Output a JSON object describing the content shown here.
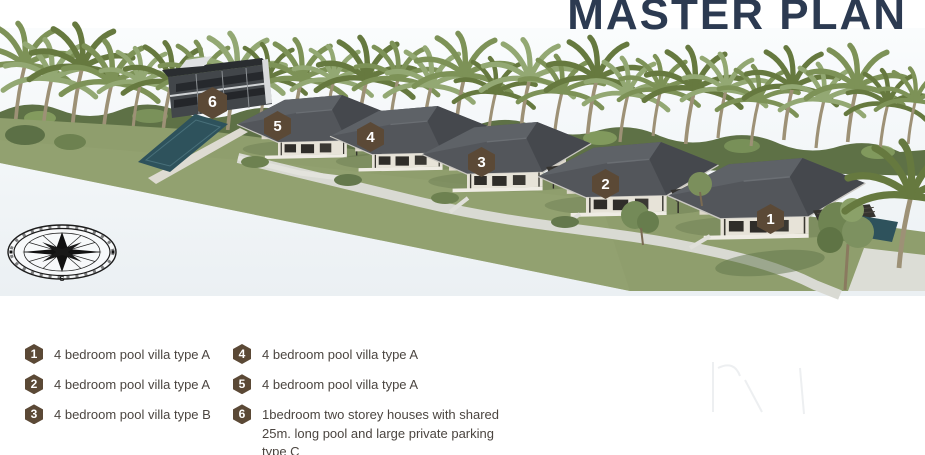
{
  "title": "MASTER PLAN",
  "plan": {
    "markers": [
      {
        "number": "1"
      },
      {
        "number": "2"
      },
      {
        "number": "3"
      },
      {
        "number": "4"
      },
      {
        "number": "5"
      },
      {
        "number": "6"
      }
    ],
    "compass": {
      "south_label": "S"
    }
  },
  "legend": {
    "items": [
      {
        "number": "1",
        "label": "4 bedroom pool villa type A"
      },
      {
        "number": "2",
        "label": "4 bedroom pool villa type A"
      },
      {
        "number": "3",
        "label": "4 bedroom pool villa type B"
      },
      {
        "number": "4",
        "label": "4 bedroom pool villa type A"
      },
      {
        "number": "5",
        "label": "4 bedroom pool villa type A"
      },
      {
        "number": "6",
        "label": "1bedroom two storey houses with shared 25m. long pool and large private parking type C"
      }
    ]
  },
  "colors": {
    "title_navy": "#2C3A51",
    "marker_brown": "#5B4936",
    "legend_text": "#4B4540",
    "lawn_green": "#8F9E6D",
    "pool_teal": "#2E525C",
    "roof_gray": "#4D5055"
  }
}
